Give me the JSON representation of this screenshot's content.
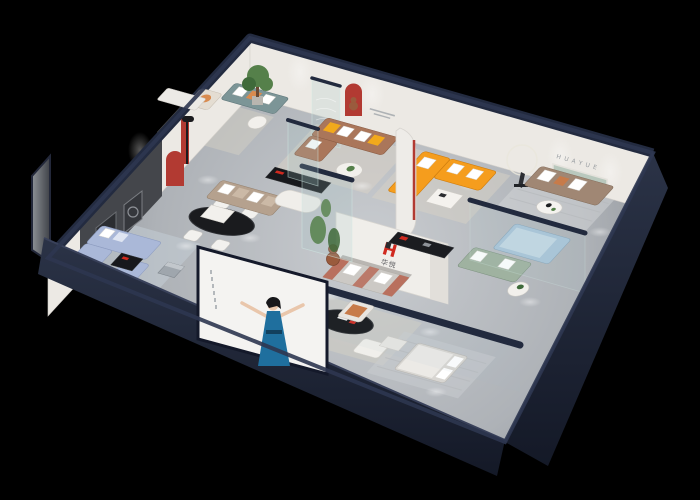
{
  "scene": {
    "kind": "3d-isometric-showroom-floorplan-render",
    "background": "#000000",
    "description": "dollhouse cutaway view of a furniture showroom with living, dining and bedroom vignettes"
  },
  "brand": {
    "logo_mark": "H",
    "logo_name": "华悦",
    "wall_letters": "HUAYUE"
  },
  "colors": {
    "outer_navy": "#222a3e",
    "front_face_light": "#2b3347",
    "front_face_dark": "#141927",
    "floor_light": "#c9ccd0",
    "floor_dark": "#93979d",
    "wall_white": "#ece9e4",
    "art_wall": "#44464b",
    "accent_red": "#b23a32",
    "logo_red": "#d0291f",
    "orange_sofa": "#f59d1d",
    "yellow_pillow": "#f2a91c",
    "brown_sofa": "#aa765a",
    "taupe_sofa": "#b5a18e",
    "right_sofa": "#a08774",
    "blue_sofa": "#aab8d8",
    "sage_sofa": "#9fb2a0",
    "blue_bed": "#a9c4d8",
    "rust_accent": "#b9705e",
    "teal_sofa": "#7c9597",
    "plant_green": "#55804a",
    "plant_dark": "#3f6a3a",
    "glass_teal": "#9fc4bd",
    "dress_blue": "#1f6f9e",
    "skin": "#e9c6ab",
    "bear_brown": "#9a5b3d",
    "rug_beige": "#d8d2c6",
    "rug_blue": "#c6cfd8",
    "rug_grey": "#c9ccd0",
    "cream": "#e4ddd2",
    "poster_bg": "#f4f3f1"
  },
  "rooms": [
    {
      "id": "blue-living",
      "sofa_color": "#aab8d8"
    },
    {
      "id": "dining",
      "table_color": "#1a1b1e"
    },
    {
      "id": "art-gallery-wall",
      "panel_color": "#44464b"
    },
    {
      "id": "teal-lounge",
      "sofa_color": "#7c9597"
    },
    {
      "id": "brown-sofa-living",
      "sofa_color": "#aa765a"
    },
    {
      "id": "huayue-feature-lounge",
      "sofa_color": "#a08774"
    },
    {
      "id": "orange-sectional-zone",
      "sofa_color": "#f59d1d"
    },
    {
      "id": "sage-and-bed-zone",
      "sofa_color": "#9fb2a0"
    },
    {
      "id": "front-bedroom",
      "bed_color": "#d8d6d2"
    },
    {
      "id": "logo-lounge",
      "sofa_color": "#b9705e"
    }
  ]
}
